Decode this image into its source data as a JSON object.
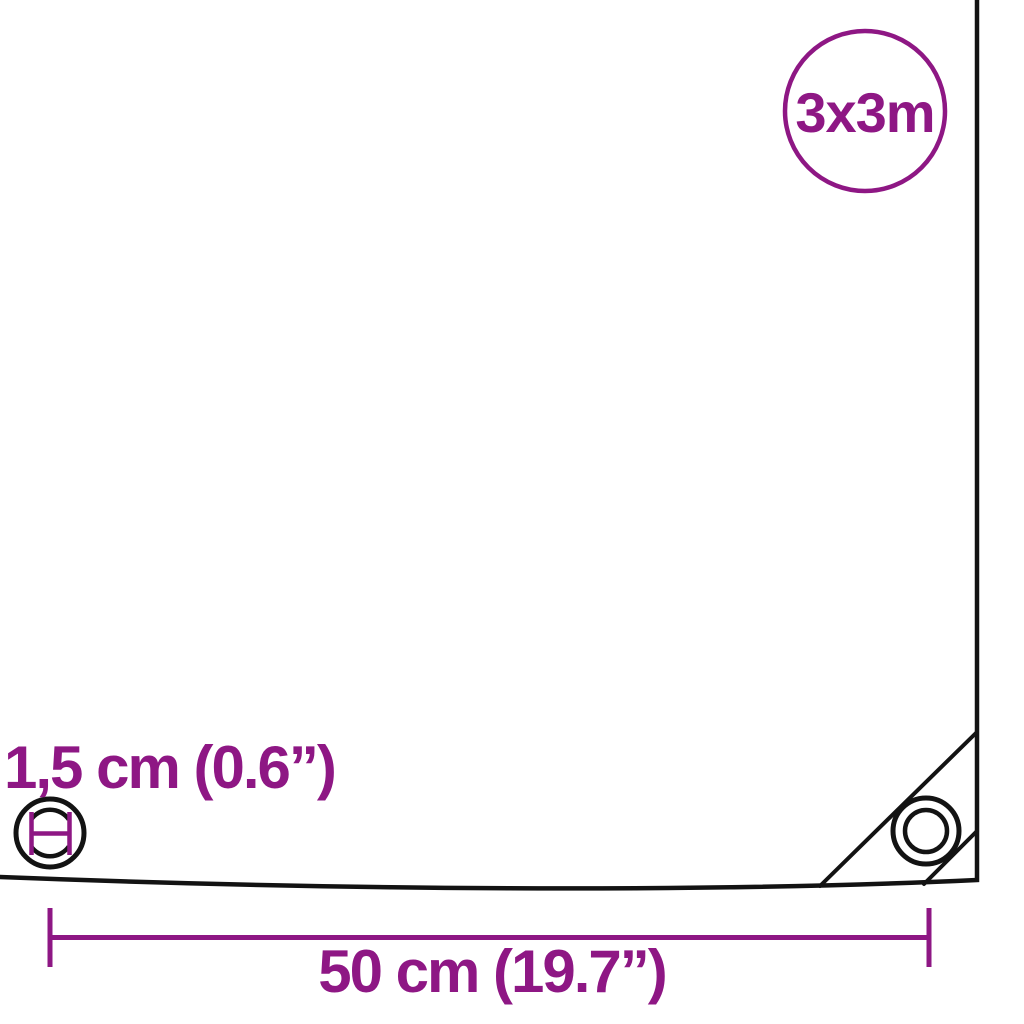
{
  "badge": {
    "size_label": "3x3m"
  },
  "annotations": {
    "grommet_diameter_label": "1,5 cm (0.6”)",
    "grommet_spacing_label": "50 cm (19.7”)"
  },
  "icons": {
    "corner_grommet_icon": "concentric-rings-eyelet",
    "grommet_diameter_icon": "eyelet-with-diameter-measure-bars"
  },
  "colors": {
    "accent": "#8E1784",
    "line": "#131313",
    "background": "#FFFFFF"
  }
}
